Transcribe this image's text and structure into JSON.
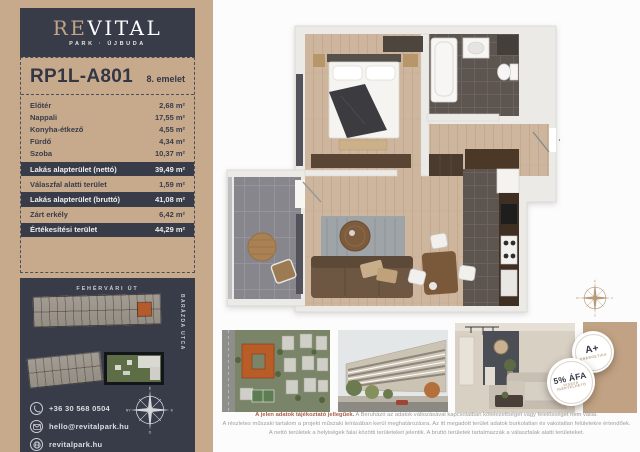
{
  "brand": {
    "name_prefix": "RE",
    "name_suffix": "VITAL",
    "subtitle": "PARK · ÚJBUDA"
  },
  "unit": {
    "id": "RP1L-A801",
    "floor": "8. emelet"
  },
  "area_table": {
    "rooms": [
      {
        "label": "Előtér",
        "value": "2,68 m²"
      },
      {
        "label": "Nappali",
        "value": "17,55 m²"
      },
      {
        "label": "Konyha-étkező",
        "value": "4,55 m²"
      },
      {
        "label": "Fürdő",
        "value": "4,34 m²"
      },
      {
        "label": "Szoba",
        "value": "10,37 m²"
      }
    ],
    "summary": [
      {
        "label": "Lakás alapterület (nettó)",
        "value": "39,49 m²"
      },
      {
        "label": "Válaszfal alatti terület",
        "value": "1,59 m²"
      },
      {
        "label": "Lakás alapterület (bruttó)",
        "value": "41,08 m²"
      },
      {
        "label": "Zárt erkély",
        "value": "6,42 m²"
      },
      {
        "label": "Értékesítési terület",
        "value": "44,29 m²"
      }
    ]
  },
  "site_map": {
    "street_top": "FEHÉRVÁRI ÚT",
    "street_right": "BARÁZDA UTCA"
  },
  "contact": {
    "phone": "+36 30 568 0504",
    "email": "hello@revitalpark.hu",
    "website": "revitalpark.hu"
  },
  "badges": {
    "energy_grade": "A+",
    "energy_label": "ENERGETIKA",
    "vat_title": "5% ÁFA",
    "vat_line1": "VISSZA",
    "vat_line2": "IGÉNYELHETŐ"
  },
  "compass": {
    "north": "É",
    "east": "K",
    "south": "D",
    "west": "NY"
  },
  "disclaimer": {
    "lead": "A jelen adatok tájékoztató jellegűek.",
    "line1_rest": " A Beruházó az adatok változásával kapcsolatban kötelezettséget vagy felelősséget nem vállal.",
    "line2": "A részletes műszaki tartalom a projekt műszaki leírásában kerül meghatározásra. Az itt megadott terület adatok burkolatlan és vakolatlan felületekre értendőek.",
    "line3": "A nettó területek a helyiségek falai közötti területeket jelentik. A bruttó területek tartalmazzák a válaszfalak alatti területeket."
  },
  "colors": {
    "tan": "#c7aa8c",
    "dark": "#383c49",
    "highlight_orange": "#b55a2b"
  }
}
